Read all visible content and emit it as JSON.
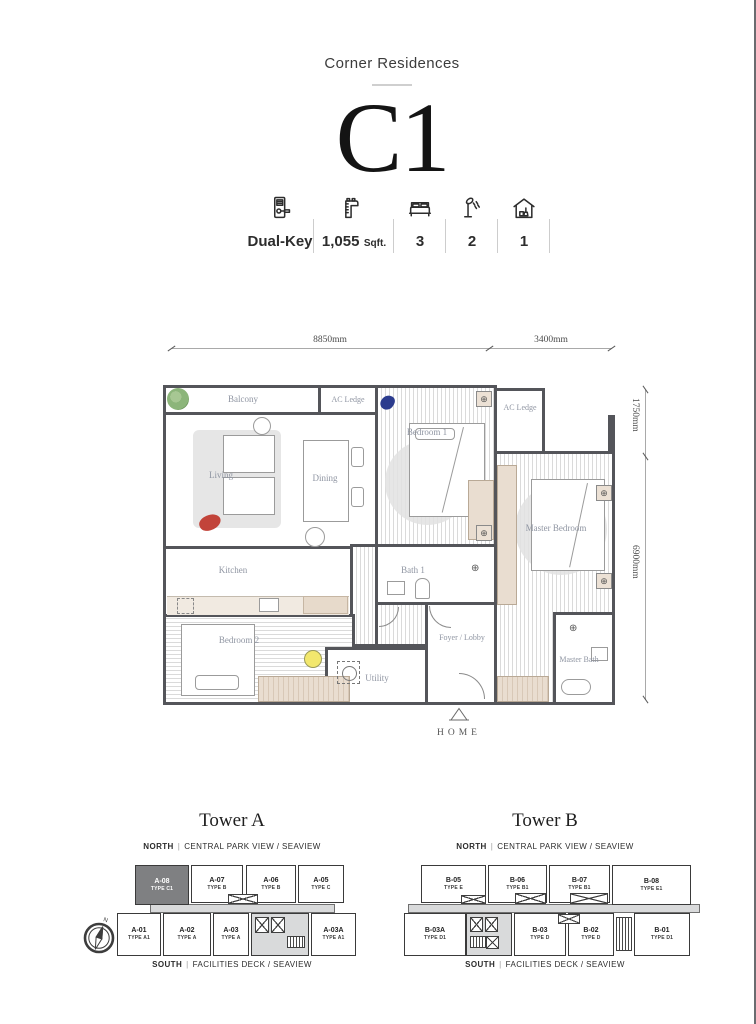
{
  "header": {
    "project_name": "Corner Residences",
    "unit_code": "C1"
  },
  "specs": {
    "items": [
      {
        "name": "dual-key",
        "label": "Dual-Key",
        "suffix": ""
      },
      {
        "name": "area",
        "label": "1,055",
        "suffix": "Sqft."
      },
      {
        "name": "bedrooms",
        "label": "3",
        "suffix": ""
      },
      {
        "name": "bathrooms",
        "label": "2",
        "suffix": ""
      },
      {
        "name": "utility",
        "label": "1",
        "suffix": ""
      }
    ]
  },
  "floor_plan": {
    "dimensions": {
      "top_main": "8850mm",
      "top_right": "3400mm",
      "right_upper": "1750mm",
      "right_lower": "6900mm"
    },
    "rooms": {
      "balcony": "Balcony",
      "ac_ledge_top": "AC Ledge",
      "ac_ledge_right": "AC Ledge",
      "living": "Living",
      "dining": "Dining",
      "kitchen": "Kitchen",
      "bedroom1": "Bedroom 1",
      "bath1": "Bath 1",
      "master_bedroom": "Master Bedroom",
      "bedroom2": "Bedroom 2",
      "foyer": "Foyer / Lobby",
      "utility": "Utility",
      "master_bath": "Master Bath"
    },
    "brand": "HOME"
  },
  "towers": [
    {
      "name": "Tower A",
      "north": {
        "dir": "NORTH",
        "view": "CENTRAL PARK VIEW / SEAVIEW"
      },
      "south": {
        "dir": "SOUTH",
        "view": "FACILITIES DECK / SEAVIEW"
      },
      "top_units": [
        {
          "id": "A-08",
          "type": "TYPE C1"
        },
        {
          "id": "A-07",
          "type": "TYPE B"
        },
        {
          "id": "A-06",
          "type": "TYPE B"
        },
        {
          "id": "A-05",
          "type": "TYPE C"
        }
      ],
      "bottom_units": [
        {
          "id": "A-01",
          "type": "TYPE A1"
        },
        {
          "id": "A-02",
          "type": "TYPE A"
        },
        {
          "id": "A-03",
          "type": "TYPE A"
        },
        {
          "id": "A-03A",
          "type": "TYPE A1"
        }
      ]
    },
    {
      "name": "Tower B",
      "north": {
        "dir": "NORTH",
        "view": "CENTRAL PARK VIEW / SEAVIEW"
      },
      "south": {
        "dir": "SOUTH",
        "view": "FACILITIES DECK / SEAVIEW"
      },
      "top_units": [
        {
          "id": "B-05",
          "type": "TYPE E"
        },
        {
          "id": "B-06",
          "type": "TYPE B1"
        },
        {
          "id": "B-07",
          "type": "TYPE B1"
        },
        {
          "id": "B-08",
          "type": "TYPE E1"
        }
      ],
      "bottom_units": [
        {
          "id": "B-03A",
          "type": "TYPE D1"
        },
        {
          "id": "B-03",
          "type": "TYPE D"
        },
        {
          "id": "B-02",
          "type": "TYPE D"
        },
        {
          "id": "B-01",
          "type": "TYPE D1"
        }
      ]
    }
  ],
  "colors": {
    "wall": "#54555a",
    "highlight_unit": "#7f8082",
    "accent_red": "#c2443a",
    "accent_blue": "#2c3c8e",
    "accent_yellow": "#f2e76d",
    "accent_green": "#8cb57a"
  },
  "misc": {
    "pipe": "|",
    "compass_n": "N",
    "vent_glyph": "⊕",
    "trap_glyph": "⊕"
  }
}
